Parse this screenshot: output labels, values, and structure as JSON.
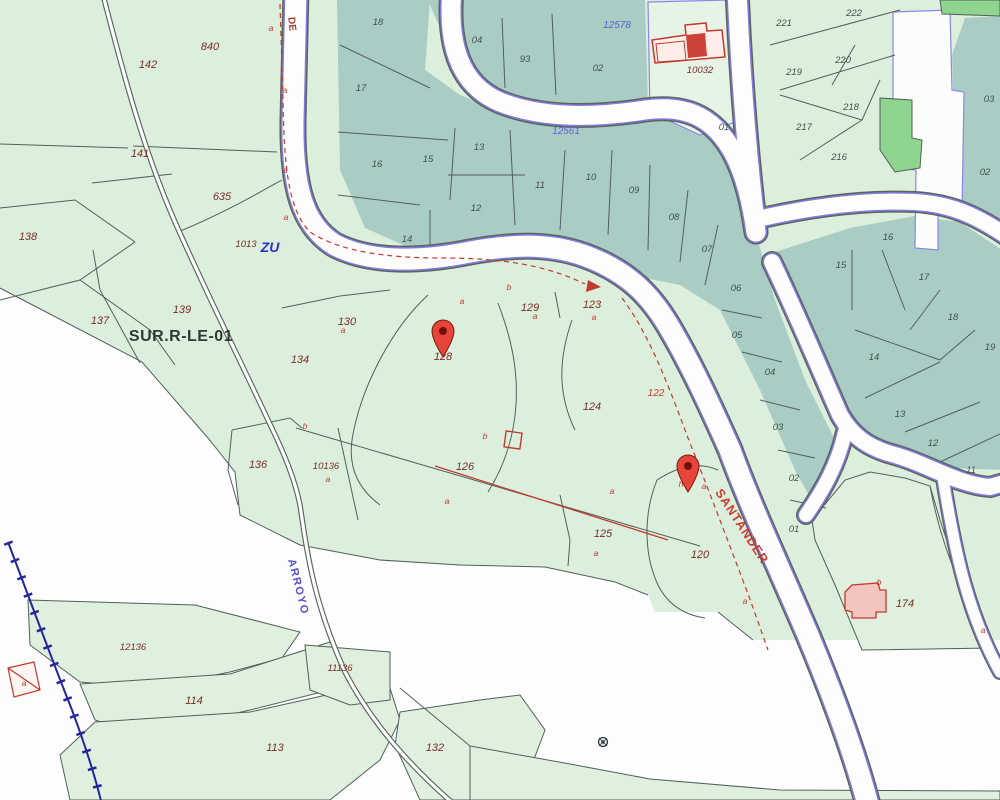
{
  "map": {
    "zone_label": "SUR.R-LE-01",
    "streets": {
      "de": "DE",
      "santander": "SANTANDER",
      "arroyo": "ARROYO"
    },
    "refs": {
      "ref_12578": "12578",
      "ref_12561": "12561",
      "zu": "ZU"
    },
    "colors": {
      "base_green": "#dcefdc",
      "urban_teal": "#a9cdc4",
      "bright_green": "#8fd48f",
      "road_white": "#fcfdfc",
      "road_purple": "#837ae0",
      "boundary": "#51605a",
      "red_marking": "#c83a2e",
      "rural_number": "#7b2d26",
      "urban_number": "#41524a",
      "blue_ref": "#5b5bd8",
      "railway_blue": "#26269a",
      "pin_red": "#e8453a",
      "building_pink": "#f2c6bf"
    },
    "pins": [
      {
        "name": "location-pin-1",
        "x": 443,
        "y": 357
      },
      {
        "name": "location-pin-2",
        "x": 688,
        "y": 492
      }
    ],
    "labels": [
      {
        "t": "142",
        "x": 148,
        "y": 68,
        "k": "rural"
      },
      {
        "t": "141",
        "x": 140,
        "y": 157,
        "k": "rural"
      },
      {
        "t": "138",
        "x": 28,
        "y": 240,
        "k": "rural"
      },
      {
        "t": "137",
        "x": 100,
        "y": 324,
        "k": "rural"
      },
      {
        "t": "139",
        "x": 182,
        "y": 313,
        "k": "rural"
      },
      {
        "t": "840",
        "x": 210,
        "y": 50,
        "k": "rural"
      },
      {
        "t": "635",
        "x": 222,
        "y": 200,
        "k": "rural"
      },
      {
        "t": "130",
        "x": 347,
        "y": 325,
        "k": "rural"
      },
      {
        "t": "134",
        "x": 300,
        "y": 363,
        "k": "rural"
      },
      {
        "t": "136",
        "x": 258,
        "y": 468,
        "k": "rural"
      },
      {
        "t": "128",
        "x": 443,
        "y": 360,
        "k": "rural"
      },
      {
        "t": "129",
        "x": 530,
        "y": 311,
        "k": "rural"
      },
      {
        "t": "123",
        "x": 592,
        "y": 308,
        "k": "rural"
      },
      {
        "t": "124",
        "x": 592,
        "y": 410,
        "k": "rural"
      },
      {
        "t": "126",
        "x": 465,
        "y": 470,
        "k": "rural"
      },
      {
        "t": "125",
        "x": 603,
        "y": 537,
        "k": "rural"
      },
      {
        "t": "120",
        "x": 700,
        "y": 558,
        "k": "rural"
      },
      {
        "t": "174",
        "x": 905,
        "y": 607,
        "k": "rural"
      },
      {
        "t": "114",
        "x": 194,
        "y": 704,
        "k": "rural"
      },
      {
        "t": "113",
        "x": 275,
        "y": 751,
        "k": "rural"
      },
      {
        "t": "132",
        "x": 435,
        "y": 751,
        "k": "rural"
      },
      {
        "t": "1013",
        "x": 246,
        "y": 247,
        "k": "rural2"
      },
      {
        "t": "10136",
        "x": 326,
        "y": 469,
        "k": "rural2"
      },
      {
        "t": "10032",
        "x": 700,
        "y": 73,
        "k": "rural2"
      },
      {
        "t": "12136",
        "x": 133,
        "y": 650,
        "k": "rural2"
      },
      {
        "t": "11136",
        "x": 340,
        "y": 671,
        "k": "rural2"
      },
      {
        "t": "122",
        "x": 656,
        "y": 396,
        "k": "rednum"
      },
      {
        "t": "18",
        "x": 378,
        "y": 25,
        "k": "urban"
      },
      {
        "t": "17",
        "x": 361,
        "y": 91,
        "k": "urban"
      },
      {
        "t": "16",
        "x": 377,
        "y": 167,
        "k": "urban"
      },
      {
        "t": "15",
        "x": 428,
        "y": 162,
        "k": "urban"
      },
      {
        "t": "13",
        "x": 479,
        "y": 150,
        "k": "urban"
      },
      {
        "t": "12",
        "x": 476,
        "y": 211,
        "k": "urban"
      },
      {
        "t": "14",
        "x": 407,
        "y": 242,
        "k": "urban"
      },
      {
        "t": "04",
        "x": 477,
        "y": 43,
        "k": "urban"
      },
      {
        "t": "93",
        "x": 525,
        "y": 62,
        "k": "urban"
      },
      {
        "t": "02",
        "x": 598,
        "y": 71,
        "k": "urban"
      },
      {
        "t": "11",
        "x": 540,
        "y": 188,
        "k": "urban"
      },
      {
        "t": "10",
        "x": 591,
        "y": 180,
        "k": "urban"
      },
      {
        "t": "09",
        "x": 634,
        "y": 193,
        "k": "urban"
      },
      {
        "t": "08",
        "x": 674,
        "y": 220,
        "k": "urban"
      },
      {
        "t": "07",
        "x": 707,
        "y": 252,
        "k": "urban"
      },
      {
        "t": "06",
        "x": 736,
        "y": 291,
        "k": "urban"
      },
      {
        "t": "05",
        "x": 737,
        "y": 338,
        "k": "urban"
      },
      {
        "t": "04",
        "x": 770,
        "y": 375,
        "k": "urban"
      },
      {
        "t": "03",
        "x": 778,
        "y": 430,
        "k": "urban"
      },
      {
        "t": "02",
        "x": 794,
        "y": 481,
        "k": "urban"
      },
      {
        "t": "01",
        "x": 794,
        "y": 532,
        "k": "urban"
      },
      {
        "t": "01",
        "x": 724,
        "y": 130,
        "k": "urban"
      },
      {
        "t": "221",
        "x": 784,
        "y": 26,
        "k": "urban"
      },
      {
        "t": "222",
        "x": 854,
        "y": 16,
        "k": "urban"
      },
      {
        "t": "219",
        "x": 794,
        "y": 75,
        "k": "urban"
      },
      {
        "t": "220",
        "x": 843,
        "y": 63,
        "k": "urban"
      },
      {
        "t": "218",
        "x": 851,
        "y": 110,
        "k": "urban"
      },
      {
        "t": "217",
        "x": 804,
        "y": 130,
        "k": "urban"
      },
      {
        "t": "216",
        "x": 839,
        "y": 160,
        "k": "urban"
      },
      {
        "t": "16",
        "x": 888,
        "y": 240,
        "k": "urban"
      },
      {
        "t": "15",
        "x": 841,
        "y": 268,
        "k": "urban"
      },
      {
        "t": "17",
        "x": 924,
        "y": 280,
        "k": "urban"
      },
      {
        "t": "18",
        "x": 953,
        "y": 320,
        "k": "urban"
      },
      {
        "t": "19",
        "x": 990,
        "y": 350,
        "k": "urban"
      },
      {
        "t": "14",
        "x": 874,
        "y": 360,
        "k": "urban"
      },
      {
        "t": "13",
        "x": 900,
        "y": 417,
        "k": "urban"
      },
      {
        "t": "12",
        "x": 933,
        "y": 446,
        "k": "urban"
      },
      {
        "t": "11",
        "x": 971,
        "y": 473,
        "k": "urban"
      },
      {
        "t": "03",
        "x": 989,
        "y": 102,
        "k": "urban"
      },
      {
        "t": "02",
        "x": 985,
        "y": 175,
        "k": "urban"
      },
      {
        "t": "a",
        "x": 271,
        "y": 31,
        "k": "redl"
      },
      {
        "t": "a",
        "x": 285,
        "y": 93,
        "k": "redl"
      },
      {
        "t": "a",
        "x": 285,
        "y": 173,
        "k": "redl"
      },
      {
        "t": "a",
        "x": 286,
        "y": 220,
        "k": "redl"
      },
      {
        "t": "a",
        "x": 462,
        "y": 304,
        "k": "redl"
      },
      {
        "t": "b",
        "x": 509,
        "y": 290,
        "k": "redl"
      },
      {
        "t": "a",
        "x": 535,
        "y": 319,
        "k": "redl"
      },
      {
        "t": "a",
        "x": 594,
        "y": 320,
        "k": "redl"
      },
      {
        "t": "a",
        "x": 343,
        "y": 333,
        "k": "redl"
      },
      {
        "t": "b",
        "x": 305,
        "y": 429,
        "k": "redl"
      },
      {
        "t": "a",
        "x": 328,
        "y": 482,
        "k": "redl"
      },
      {
        "t": "b",
        "x": 485,
        "y": 439,
        "k": "redl"
      },
      {
        "t": "a",
        "x": 447,
        "y": 504,
        "k": "redl"
      },
      {
        "t": "a",
        "x": 612,
        "y": 494,
        "k": "redl"
      },
      {
        "t": "a",
        "x": 596,
        "y": 556,
        "k": "redl"
      },
      {
        "t": "h",
        "x": 681,
        "y": 487,
        "k": "redl"
      },
      {
        "t": "a",
        "x": 704,
        "y": 489,
        "k": "redl"
      },
      {
        "t": "a",
        "x": 745,
        "y": 604,
        "k": "redl"
      },
      {
        "t": "b",
        "x": 879,
        "y": 585,
        "k": "redl"
      },
      {
        "t": "a",
        "x": 983,
        "y": 633,
        "k": "redl"
      },
      {
        "t": "a",
        "x": 24,
        "y": 686,
        "k": "redl"
      }
    ]
  }
}
